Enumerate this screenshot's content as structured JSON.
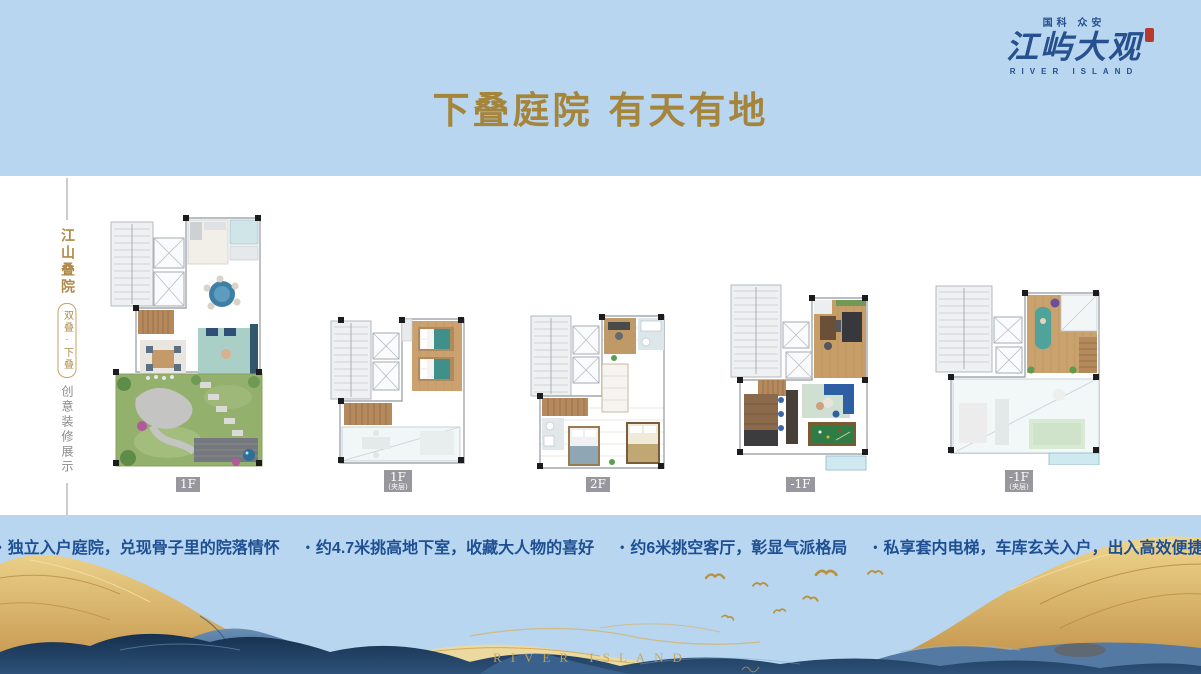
{
  "brand": {
    "pre_title": "国科 众安",
    "name": "江屿大观",
    "sub": "RIVER ISLAND"
  },
  "header": {
    "title": "下叠庭院 有天有地"
  },
  "side_label": {
    "main": "江山叠院",
    "badge": "双叠·下叠",
    "sub": "创意装修展示"
  },
  "plans": [
    {
      "label": "1F",
      "sublabel": ""
    },
    {
      "label": "1F",
      "sublabel": "(夹层)"
    },
    {
      "label": "2F",
      "sublabel": ""
    },
    {
      "label": "-1F",
      "sublabel": ""
    },
    {
      "label": "-1F",
      "sublabel": "(夹层)"
    }
  ],
  "features": [
    "独立入户庭院，兑现骨子里的院落情怀",
    "约4.7米挑高地下室，收藏大人物的喜好",
    "约6米挑空客厅，彰显气派格局",
    "私享套内电梯，车库玄关入户，出入高效便捷"
  ],
  "footer": {
    "watermark": "RIVER ISLAND"
  },
  "colors": {
    "band_blue": "#b8d6f0",
    "title_gold": "#a5853c",
    "brand_blue": "#27508e",
    "seal_red": "#b8392e",
    "side_gold": "#b08948",
    "side_gray": "#8a8a8a",
    "feature_blue": "#1e4f93",
    "plan_label_gray": "#97979d",
    "art_gold": "#c9a353",
    "art_navy": "#1f3a5c"
  }
}
